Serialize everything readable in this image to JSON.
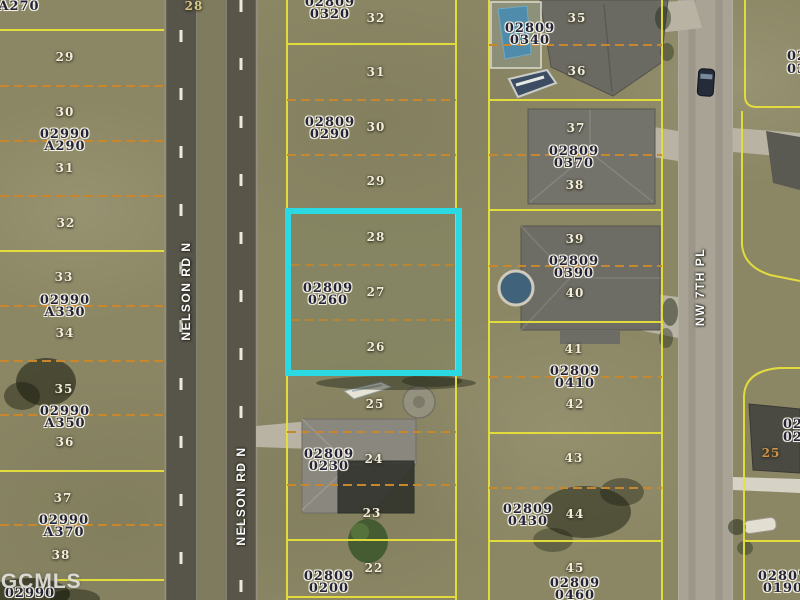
{
  "watermark": "FGCMLS",
  "roads": {
    "nelson_upper": "NELSON RD N",
    "nelson_lower": "NELSON RD N",
    "nw7th": "NW 7TH PL"
  },
  "colors": {
    "highlight": "#2bd9e2",
    "block_line": "#e7e03b",
    "lot_line": "#c8872d"
  },
  "highlight_parcel": {
    "id_line1": "02809",
    "id_line2": "0260",
    "lots": [
      "28",
      "27",
      "26"
    ]
  },
  "left_col": {
    "top_label": "A270",
    "road_number": "28",
    "lots": [
      "29",
      "30",
      "31",
      "32",
      "33",
      "34",
      "35",
      "36",
      "37",
      "38"
    ],
    "parcels": [
      {
        "l1": "02990",
        "l2": "A290"
      },
      {
        "l1": "02990",
        "l2": "A330"
      },
      {
        "l1": "02990",
        "l2": "A350"
      },
      {
        "l1": "02990",
        "l2": "A370"
      }
    ],
    "bottom_id": "02990"
  },
  "center_col": {
    "lots_top": [
      "32",
      "31",
      "30",
      "29"
    ],
    "parcels_top": [
      {
        "l1": "02809",
        "l2": "0320"
      },
      {
        "l1": "02809",
        "l2": "0290"
      }
    ],
    "lots_bottom": [
      "25",
      "24",
      "23",
      "22"
    ],
    "parcels_bottom": [
      {
        "l1": "02809",
        "l2": "0230"
      },
      {
        "l1": "02809",
        "l2": "0200"
      }
    ]
  },
  "right_col": {
    "lots": [
      "35",
      "36",
      "37",
      "38",
      "39",
      "40",
      "41",
      "42",
      "43",
      "44",
      "45"
    ],
    "parcels": [
      {
        "l1": "02809",
        "l2": "0340"
      },
      {
        "l1": "02809",
        "l2": "0370"
      },
      {
        "l1": "02809",
        "l2": "0390"
      },
      {
        "l1": "02809",
        "l2": "0410"
      },
      {
        "l1": "02809",
        "l2": "0430"
      },
      {
        "l1": "02809",
        "l2": "0460"
      }
    ]
  },
  "far_right_col": {
    "partial_top_1": "02",
    "partial_top_2": "03",
    "partial_mid_1": "02",
    "partial_mid_2": "02",
    "orange_lot": "25",
    "parcel_bottom": {
      "l1": "02807",
      "l2": "0190"
    }
  }
}
